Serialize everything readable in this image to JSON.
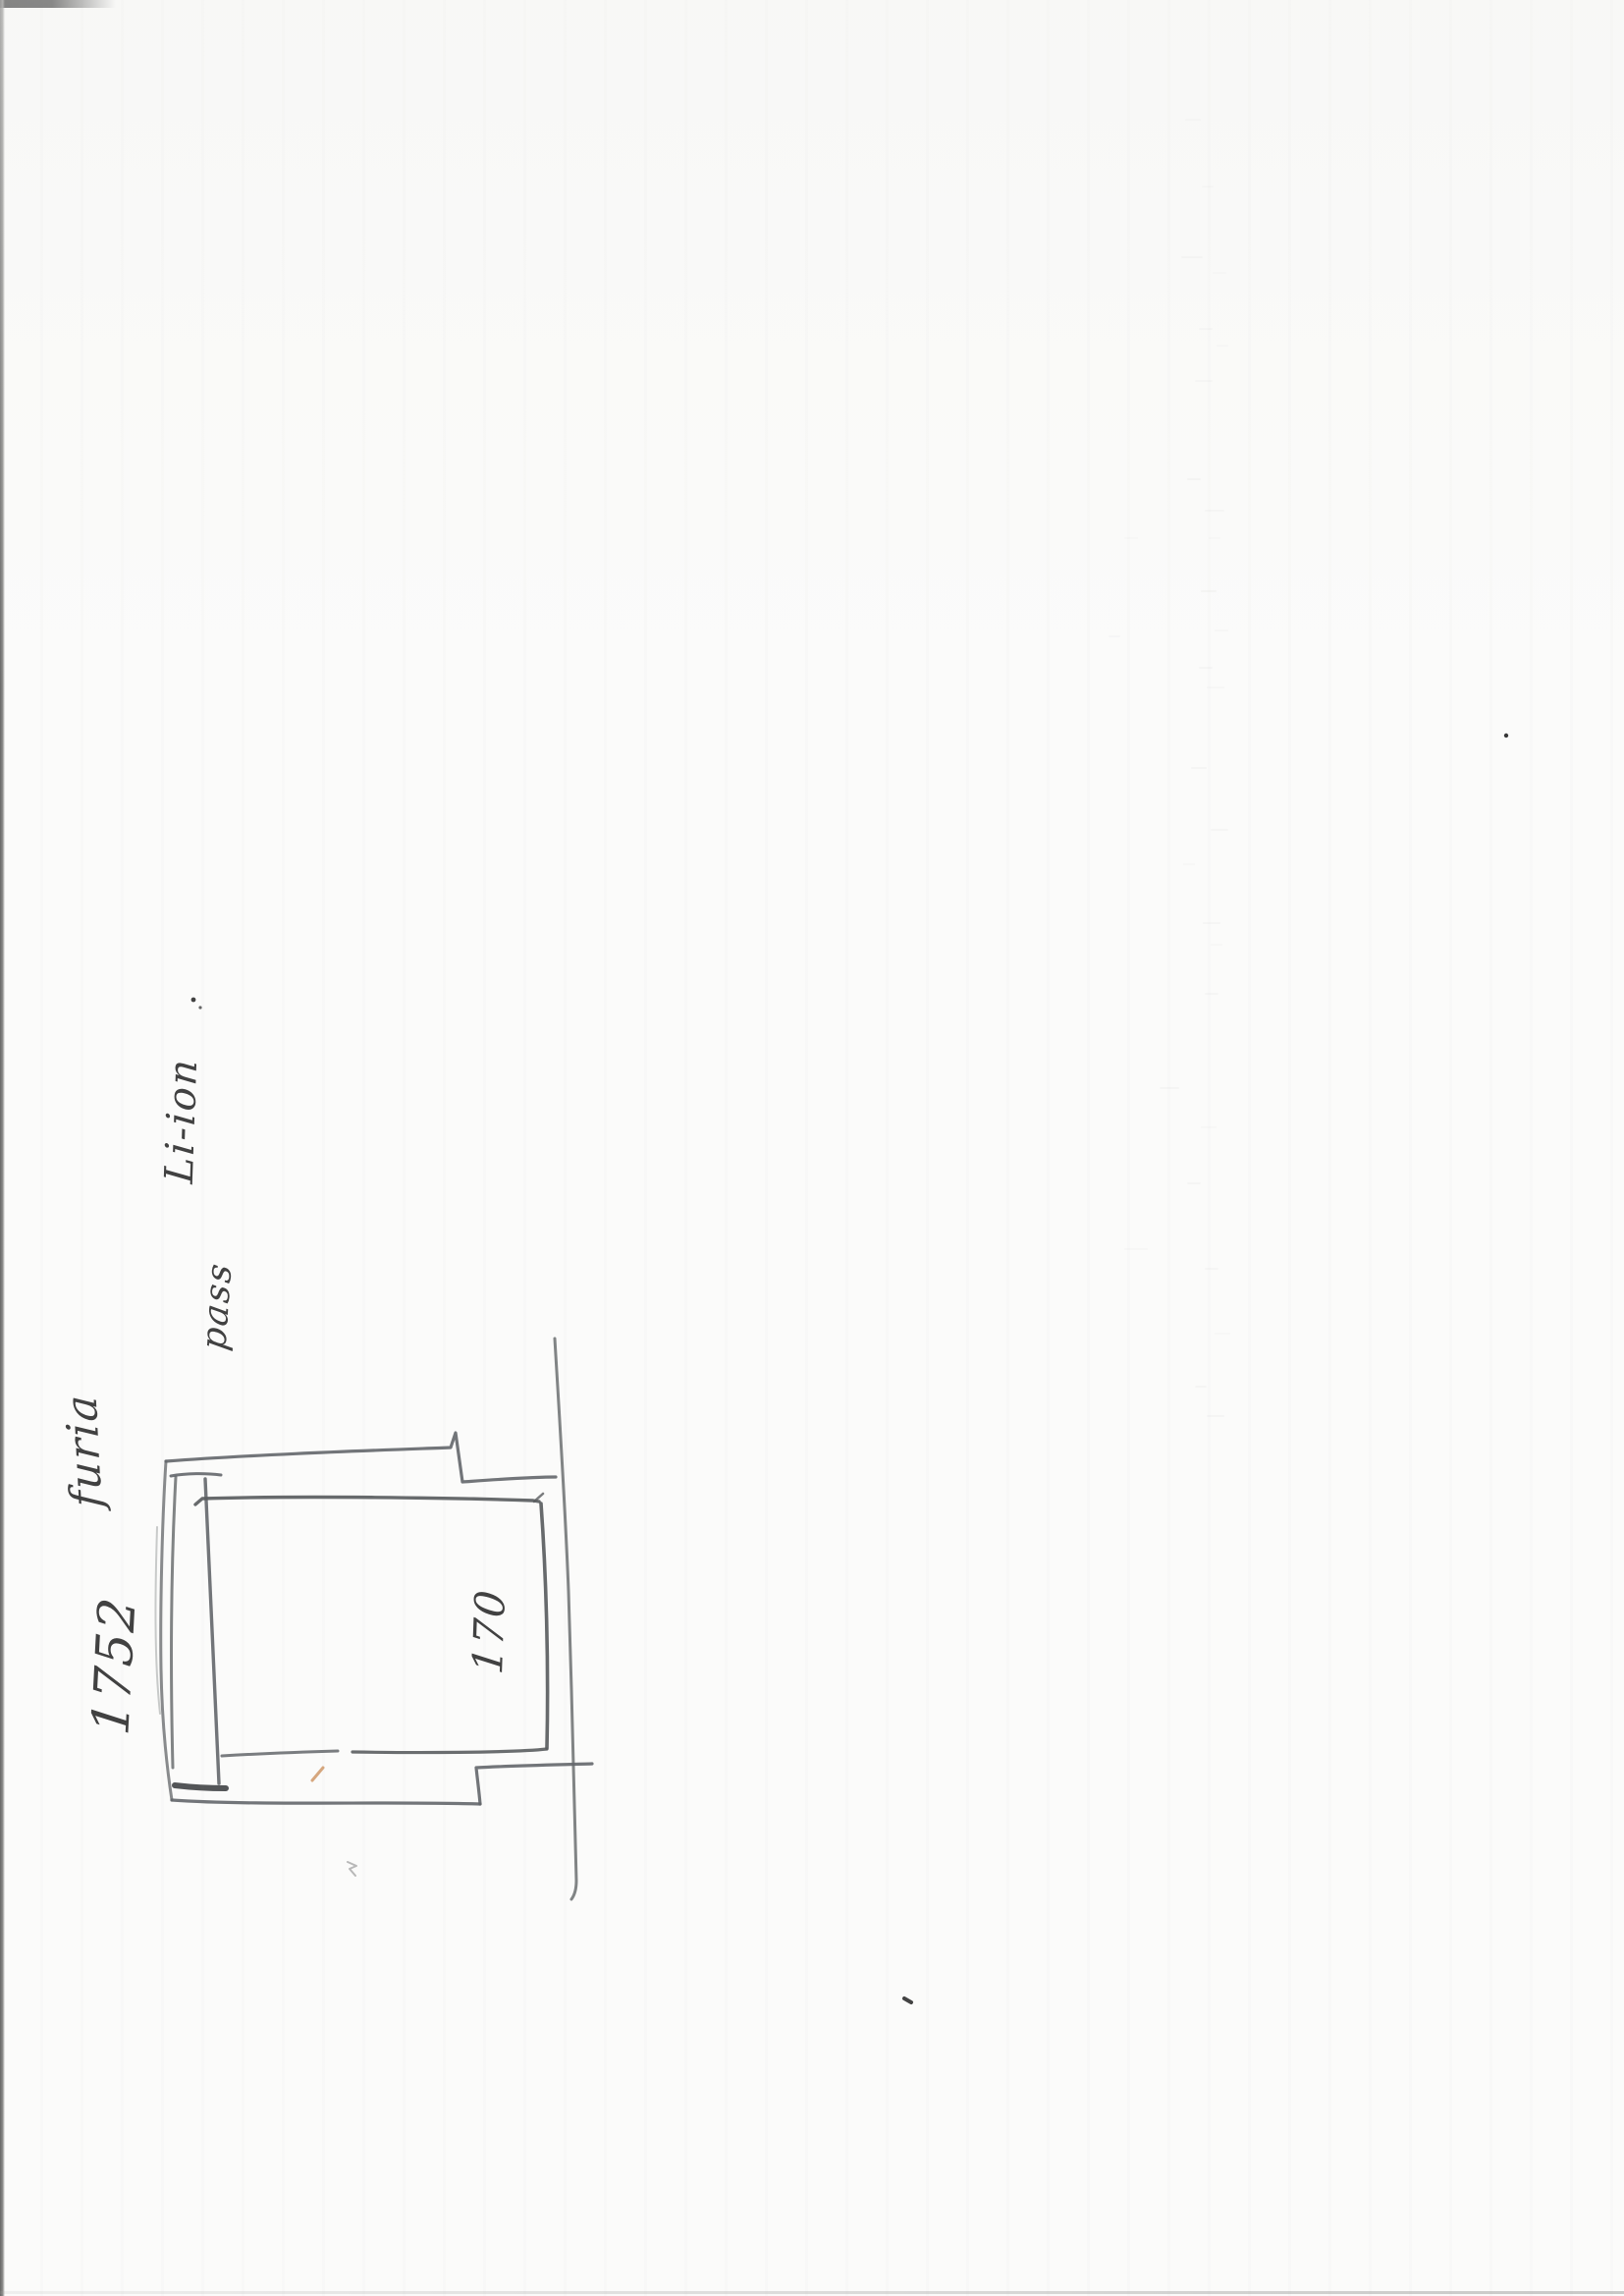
{
  "page": {
    "title": "Scanned handwritten sketch page",
    "paper_color": "#fbfbfa"
  },
  "handwriting": {
    "dimension_main": "1752",
    "word_1": "furia",
    "word_2": "pass",
    "word_3": "Li-ion",
    "inner_dimension": "170"
  },
  "colors": {
    "ink": "#414141",
    "pencil": "#6b6e70",
    "pencil_dark": "#4a4c4e",
    "accent_tick": "#c98b54"
  }
}
